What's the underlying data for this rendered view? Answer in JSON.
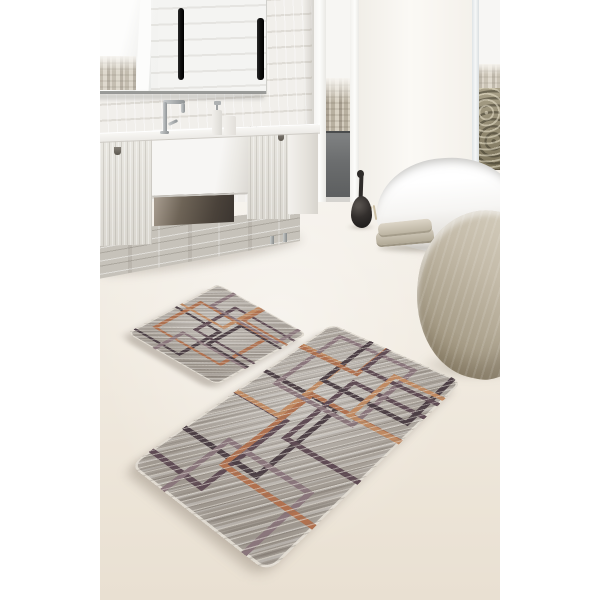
{
  "meta": {
    "type": "product-photo",
    "description": "Two-piece grey geometric bath mat set shown on the floor of a modern bathroom with whitewashed plank wall, wall mirror with black light bars, wooden vanity with white farmhouse sink and chrome faucet, floor-to-ceiling window with city view and balcony railing, white freestanding bathtub, black decorative vase, folded beige towels and a stone-shaped pouf",
    "width_px": 600,
    "height_px": 600
  },
  "product": {
    "name": "bath-mat-set",
    "pieces": [
      {
        "name": "small-mat",
        "placement": "upper area of floor",
        "pattern": "overlapping rectangle outlines"
      },
      {
        "name": "large-mat",
        "placement": "lower center of floor",
        "pattern": "overlapping rectangle outlines"
      }
    ],
    "colors": {
      "base": "#a7a098",
      "line_terracotta": "#b0714f",
      "line_light_terracotta": "#c08a62",
      "line_plum": "#5f4b54",
      "line_mauve": "#8a767c",
      "line_dark_brown": "#4c3f45",
      "edge_binding": "#e6e0d6"
    }
  },
  "scene_objects": [
    "plank-wall",
    "wall-mirror",
    "light-bar-left",
    "light-bar-right",
    "vanity-counter",
    "farmhouse-sink",
    "chrome-faucet",
    "soap-dispenser-tall",
    "soap-dispenser-short",
    "vanity-left-door",
    "vanity-right-door",
    "vanity-lower-drawer",
    "window-city-view-left",
    "balcony-railing",
    "bright-wall",
    "window-city-view-right",
    "freestanding-bathtub",
    "black-vase",
    "dried-sprig",
    "folded-towels",
    "stone-pouf",
    "cream-floor",
    "small-bath-mat",
    "large-bath-mat"
  ],
  "palette": {
    "margin_background": "#ffffff",
    "floor": "#efe8dc",
    "wall": "#e9e7e2",
    "railing": "#6b6d6e",
    "tub": "#fbfbfa",
    "vase": "#2c2927",
    "towels": "#c9c1b0",
    "pouf": "#bdb4a1"
  }
}
